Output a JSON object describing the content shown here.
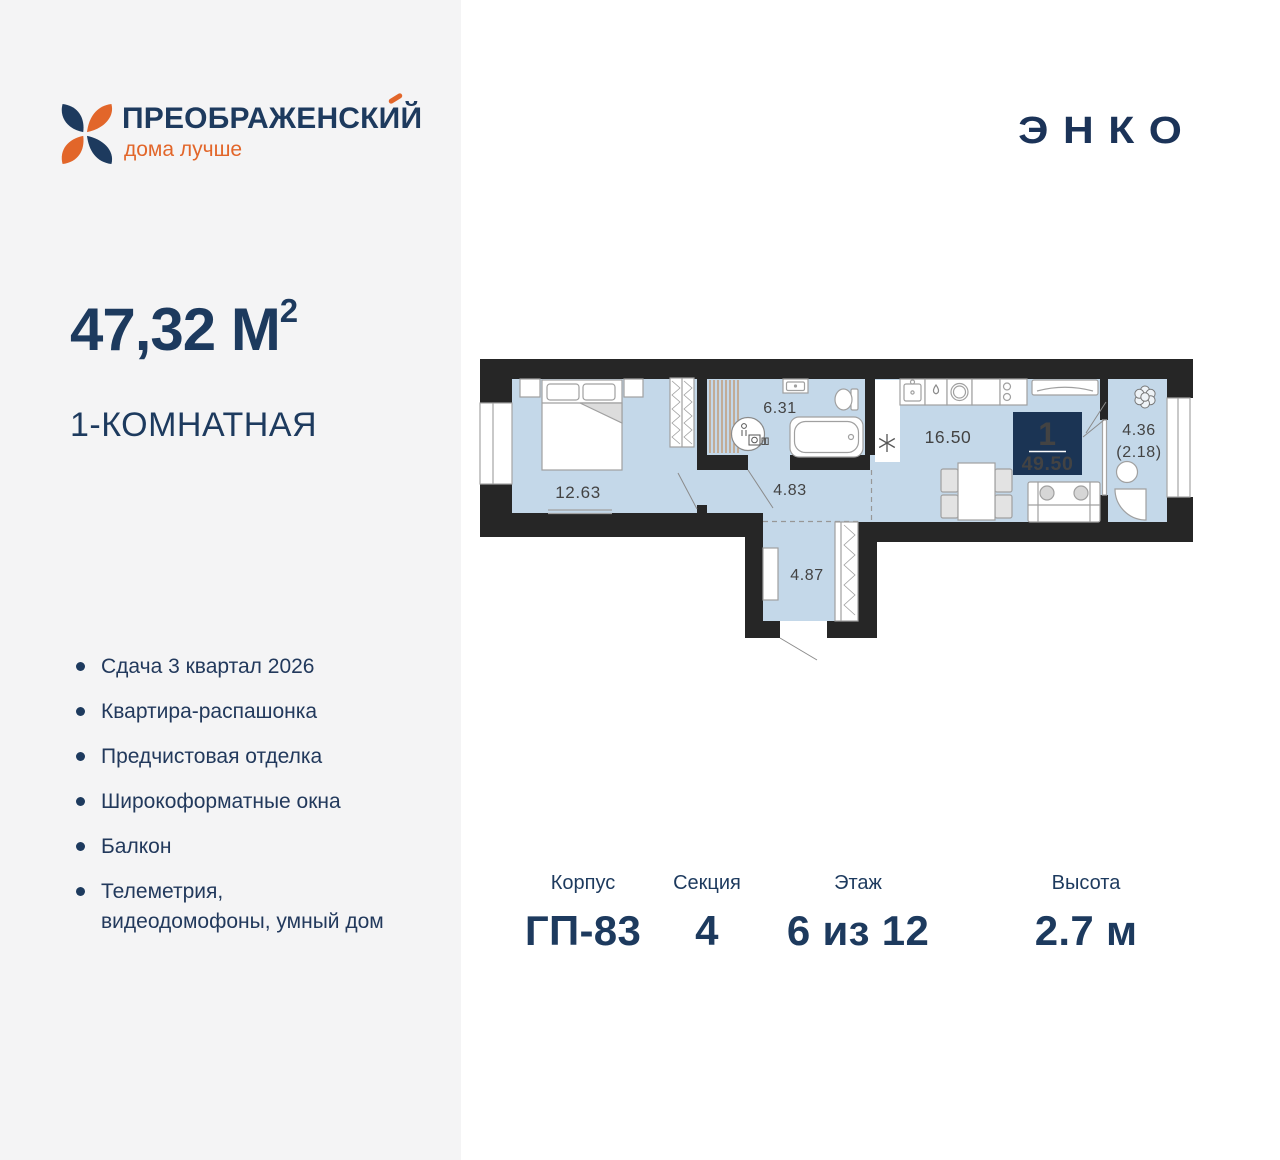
{
  "brand": {
    "name": "ПРЕОБРАЖЕНСКИЙ",
    "tagline": "дома лучше",
    "developer": "ЭНКО"
  },
  "apartment": {
    "area": "47,32 М",
    "area_sup": "2",
    "type": "1-КОМНАТНАЯ"
  },
  "features": [
    "Сдача 3 квартал 2026",
    "Квартира-распашонка",
    "Предчистовая отделка",
    "Широкоформатные окна",
    "Балкон",
    "Телеметрия, видеодомофоны, умный дом"
  ],
  "plan": {
    "labels": {
      "bedroom": "12.63",
      "bathroom": "6.31",
      "corridor": "4.83",
      "kitchen_living": "16.50",
      "hall": "4.87",
      "balcony": "4.36",
      "balcony_reduced": "(2.18)"
    },
    "badge": {
      "rooms": "1",
      "total_area": "49.50"
    }
  },
  "specs": [
    {
      "label": "Корпус",
      "value": "ГП-83"
    },
    {
      "label": "Секция",
      "value": "4"
    },
    {
      "label": "Этаж",
      "value": "6 из 12"
    },
    {
      "label": "Высота",
      "value": "2.7 м"
    }
  ],
  "colors": {
    "navy": "#1d3a5e",
    "orange": "#e2662a",
    "floor_blue": "#c4d8e9",
    "wall_dark": "#262626",
    "badge_navy": "#1b3454",
    "panel_gray": "#f4f4f5"
  }
}
